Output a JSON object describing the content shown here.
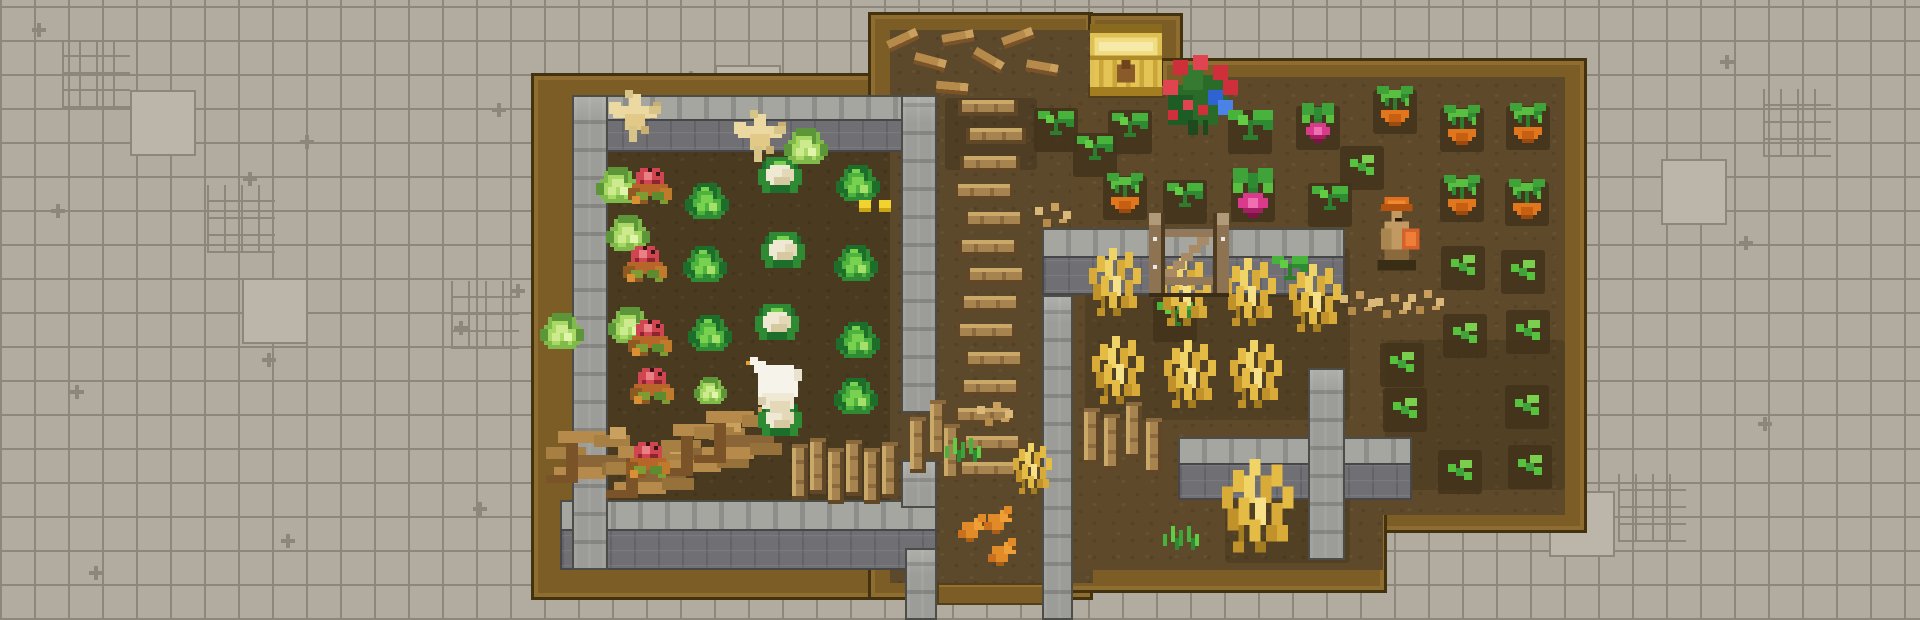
{
  "scene": {
    "width": 1920,
    "height": 620,
    "palette": {
      "bg_tile": "#b2aba0",
      "bg_grout": "#8d867b",
      "wood": "#7d5d26",
      "wood_outline": "#43320e",
      "dirt_garden": "#4a3a20",
      "dirt_path": "#5c482a",
      "dirt_field": "#5e4a2a",
      "wall_cap": "#a6a6a1",
      "wall_face": "#6f6f74",
      "hay_gold": "#e3bb45",
      "crop_green": "#3fa33a",
      "tomato_red": "#cf4550",
      "carrot_orange": "#e2761c",
      "radish_pink": "#da3a8c",
      "chest_gold": "#dfc052"
    },
    "wood": [
      [
        531,
        73,
        406,
        527
      ],
      [
        868,
        12,
        225,
        588
      ],
      [
        1088,
        13,
        95,
        82
      ],
      [
        1160,
        58,
        427,
        475
      ],
      [
        1042,
        95,
        345,
        498
      ]
    ],
    "wood2": [
      [
        937,
        583,
        129,
        22
      ],
      [
        1088,
        84,
        77,
        14
      ]
    ],
    "dirt": [
      [
        572,
        95,
        333,
        475,
        "garden"
      ],
      [
        890,
        30,
        203,
        553,
        "path"
      ],
      [
        1091,
        28,
        70,
        56,
        "alcove"
      ],
      [
        1071,
        95,
        112,
        420,
        "field"
      ],
      [
        1183,
        77,
        382,
        438,
        "field"
      ],
      [
        1066,
        515,
        317,
        55,
        "field"
      ]
    ],
    "patches_big": [
      [
        1085,
        248,
        265,
        172
      ],
      [
        945,
        98,
        92,
        72
      ],
      [
        1225,
        455,
        125,
        108
      ],
      [
        1385,
        340,
        180,
        150
      ]
    ],
    "patches": [
      [
        1125,
        198
      ],
      [
        1395,
        112
      ],
      [
        1462,
        130
      ],
      [
        1528,
        128
      ],
      [
        1462,
        200
      ],
      [
        1527,
        204
      ],
      [
        1253,
        200
      ],
      [
        1318,
        128
      ],
      [
        1250,
        132
      ],
      [
        1056,
        130
      ],
      [
        1095,
        155
      ],
      [
        1130,
        132
      ],
      [
        1185,
        202
      ],
      [
        1330,
        205
      ],
      [
        1175,
        320
      ],
      [
        1290,
        275
      ],
      [
        1362,
        168
      ],
      [
        1402,
        365
      ],
      [
        1405,
        410
      ],
      [
        1463,
        268
      ],
      [
        1465,
        336
      ],
      [
        1460,
        472
      ],
      [
        1523,
        272
      ],
      [
        1528,
        332
      ],
      [
        1527,
        407
      ],
      [
        1530,
        467
      ]
    ],
    "walls_h": [
      [
        572,
        95,
        361,
        57
      ],
      [
        560,
        500,
        377,
        70
      ],
      [
        1042,
        228,
        303,
        67
      ],
      [
        1178,
        437,
        234,
        63
      ]
    ],
    "walls_v": [
      [
        572,
        95,
        36,
        475
      ],
      [
        901,
        95,
        36,
        318
      ],
      [
        901,
        460,
        36,
        48
      ],
      [
        905,
        548,
        32,
        72
      ],
      [
        1042,
        295,
        31,
        325
      ],
      [
        1308,
        368,
        37,
        192
      ]
    ],
    "sprites": [
      [
        "stick",
        903,
        40,
        4,
        -25
      ],
      [
        "stick",
        930,
        62,
        4,
        15
      ],
      [
        "stick",
        958,
        38,
        4,
        -10
      ],
      [
        "stick",
        988,
        60,
        4,
        30
      ],
      [
        "stick",
        1018,
        38,
        4,
        -20
      ],
      [
        "stick",
        1042,
        68,
        4,
        10
      ],
      [
        "stick",
        952,
        88,
        4,
        5
      ],
      [
        "plank_h",
        988,
        108
      ],
      [
        "plank_h",
        996,
        136
      ],
      [
        "plank_h",
        990,
        164
      ],
      [
        "plank_h",
        984,
        192
      ],
      [
        "plank_h",
        994,
        220
      ],
      [
        "plank_h",
        988,
        248
      ],
      [
        "plank_h",
        996,
        276
      ],
      [
        "plank_h",
        990,
        304
      ],
      [
        "plank_h",
        986,
        332
      ],
      [
        "plank_h",
        994,
        360
      ],
      [
        "plank_h",
        990,
        388
      ],
      [
        "plank_h",
        984,
        416
      ],
      [
        "plank_h",
        992,
        444
      ],
      [
        "plank_h",
        988,
        470
      ],
      [
        "branchpile",
        590,
        455
      ],
      [
        "branchpile",
        650,
        470
      ],
      [
        "branchpile",
        705,
        448
      ],
      [
        "branchpile",
        738,
        435
      ],
      [
        "plank_v",
        800,
        472
      ],
      [
        "plank_v",
        818,
        466
      ],
      [
        "plank_v",
        836,
        476
      ],
      [
        "plank_v",
        854,
        468
      ],
      [
        "plank_v",
        872,
        476
      ],
      [
        "plank_v",
        890,
        470
      ],
      [
        "plank_v",
        918,
        445
      ],
      [
        "plank_v",
        938,
        428
      ],
      [
        "plank_v",
        952,
        452
      ],
      [
        "plank_v",
        1092,
        436
      ],
      [
        "plank_v",
        1112,
        442
      ],
      [
        "plank_v",
        1134,
        430
      ],
      [
        "plank_v",
        1154,
        446
      ],
      [
        "feed",
        997,
        414
      ],
      [
        "feed",
        1055,
        215
      ],
      [
        "feed",
        1360,
        303
      ],
      [
        "feed",
        1395,
        306
      ],
      [
        "feed",
        1428,
        302
      ],
      [
        "grass",
        965,
        450
      ],
      [
        "grass",
        1183,
        538
      ],
      [
        "cabbage_light",
        618,
        187
      ],
      [
        "tomato",
        650,
        192
      ],
      [
        "cabbage",
        707,
        203
      ],
      [
        "cauliflower",
        780,
        175
      ],
      [
        "cabbage",
        858,
        185
      ],
      [
        "cabbage_light",
        806,
        148
      ],
      [
        "cabbage_light",
        628,
        235
      ],
      [
        "tomato",
        645,
        270
      ],
      [
        "cabbage",
        705,
        266
      ],
      [
        "cauliflower",
        783,
        250
      ],
      [
        "cabbage",
        856,
        265
      ],
      [
        "cabbage_light",
        562,
        333
      ],
      [
        "cabbage_light",
        630,
        327
      ],
      [
        "tomato",
        650,
        344
      ],
      [
        "cabbage",
        710,
        335
      ],
      [
        "cauliflower",
        777,
        322
      ],
      [
        "cabbage",
        858,
        342
      ],
      [
        "tomato",
        652,
        392
      ],
      [
        "cabbage_light",
        710,
        392,
        3
      ],
      [
        "cabbage",
        856,
        398
      ],
      [
        "tomato",
        648,
        466
      ],
      [
        "cauliflower",
        780,
        418
      ],
      [
        "yellow_item",
        875,
        208
      ],
      [
        "seedling",
        1056,
        127
      ],
      [
        "seedling",
        1095,
        152
      ],
      [
        "seedling",
        1130,
        129
      ],
      [
        "carrot",
        1125,
        195
      ],
      [
        "flowerbush",
        1198,
        95,
        5
      ],
      [
        "seedling",
        1250,
        130,
        5
      ],
      [
        "radish",
        1253,
        195,
        5
      ],
      [
        "radish",
        1318,
        125
      ],
      [
        "carrot",
        1395,
        108
      ],
      [
        "carrot",
        1462,
        127
      ],
      [
        "carrot",
        1528,
        125
      ],
      [
        "carrot",
        1462,
        197
      ],
      [
        "carrot",
        1527,
        201
      ],
      [
        "seedling",
        1185,
        199
      ],
      [
        "seedling",
        1330,
        202
      ],
      [
        "seedling",
        1175,
        318
      ],
      [
        "seedling",
        1290,
        272
      ],
      [
        "sprout",
        1362,
        165
      ],
      [
        "sprout",
        1402,
        362
      ],
      [
        "sprout",
        1405,
        408
      ],
      [
        "sprout",
        1463,
        265
      ],
      [
        "sprout",
        1465,
        333
      ],
      [
        "sprout",
        1460,
        470
      ],
      [
        "sprout",
        1523,
        270
      ],
      [
        "sprout",
        1528,
        330
      ],
      [
        "sprout",
        1527,
        405
      ],
      [
        "sprout",
        1530,
        465
      ],
      [
        "hay",
        1115,
        282
      ],
      [
        "hay",
        1185,
        292
      ],
      [
        "hay",
        1250,
        292
      ],
      [
        "hay",
        1315,
        298
      ],
      [
        "hay",
        1118,
        370
      ],
      [
        "hay",
        1190,
        374
      ],
      [
        "hay",
        1256,
        374
      ],
      [
        "hay",
        1032,
        468,
        3
      ],
      [
        "hay",
        1258,
        506,
        5.5
      ],
      [
        "chest",
        1126,
        60,
        4.5
      ],
      [
        "gate",
        1189,
        255
      ],
      [
        "bird_cream",
        635,
        120
      ],
      [
        "bird_cream",
        760,
        140
      ],
      [
        "bird_white",
        776,
        385
      ],
      [
        "chick",
        972,
        528
      ],
      [
        "chick",
        998,
        520
      ],
      [
        "chick",
        1002,
        552
      ],
      [
        "dwarf",
        1397,
        235,
        3.5
      ]
    ]
  }
}
